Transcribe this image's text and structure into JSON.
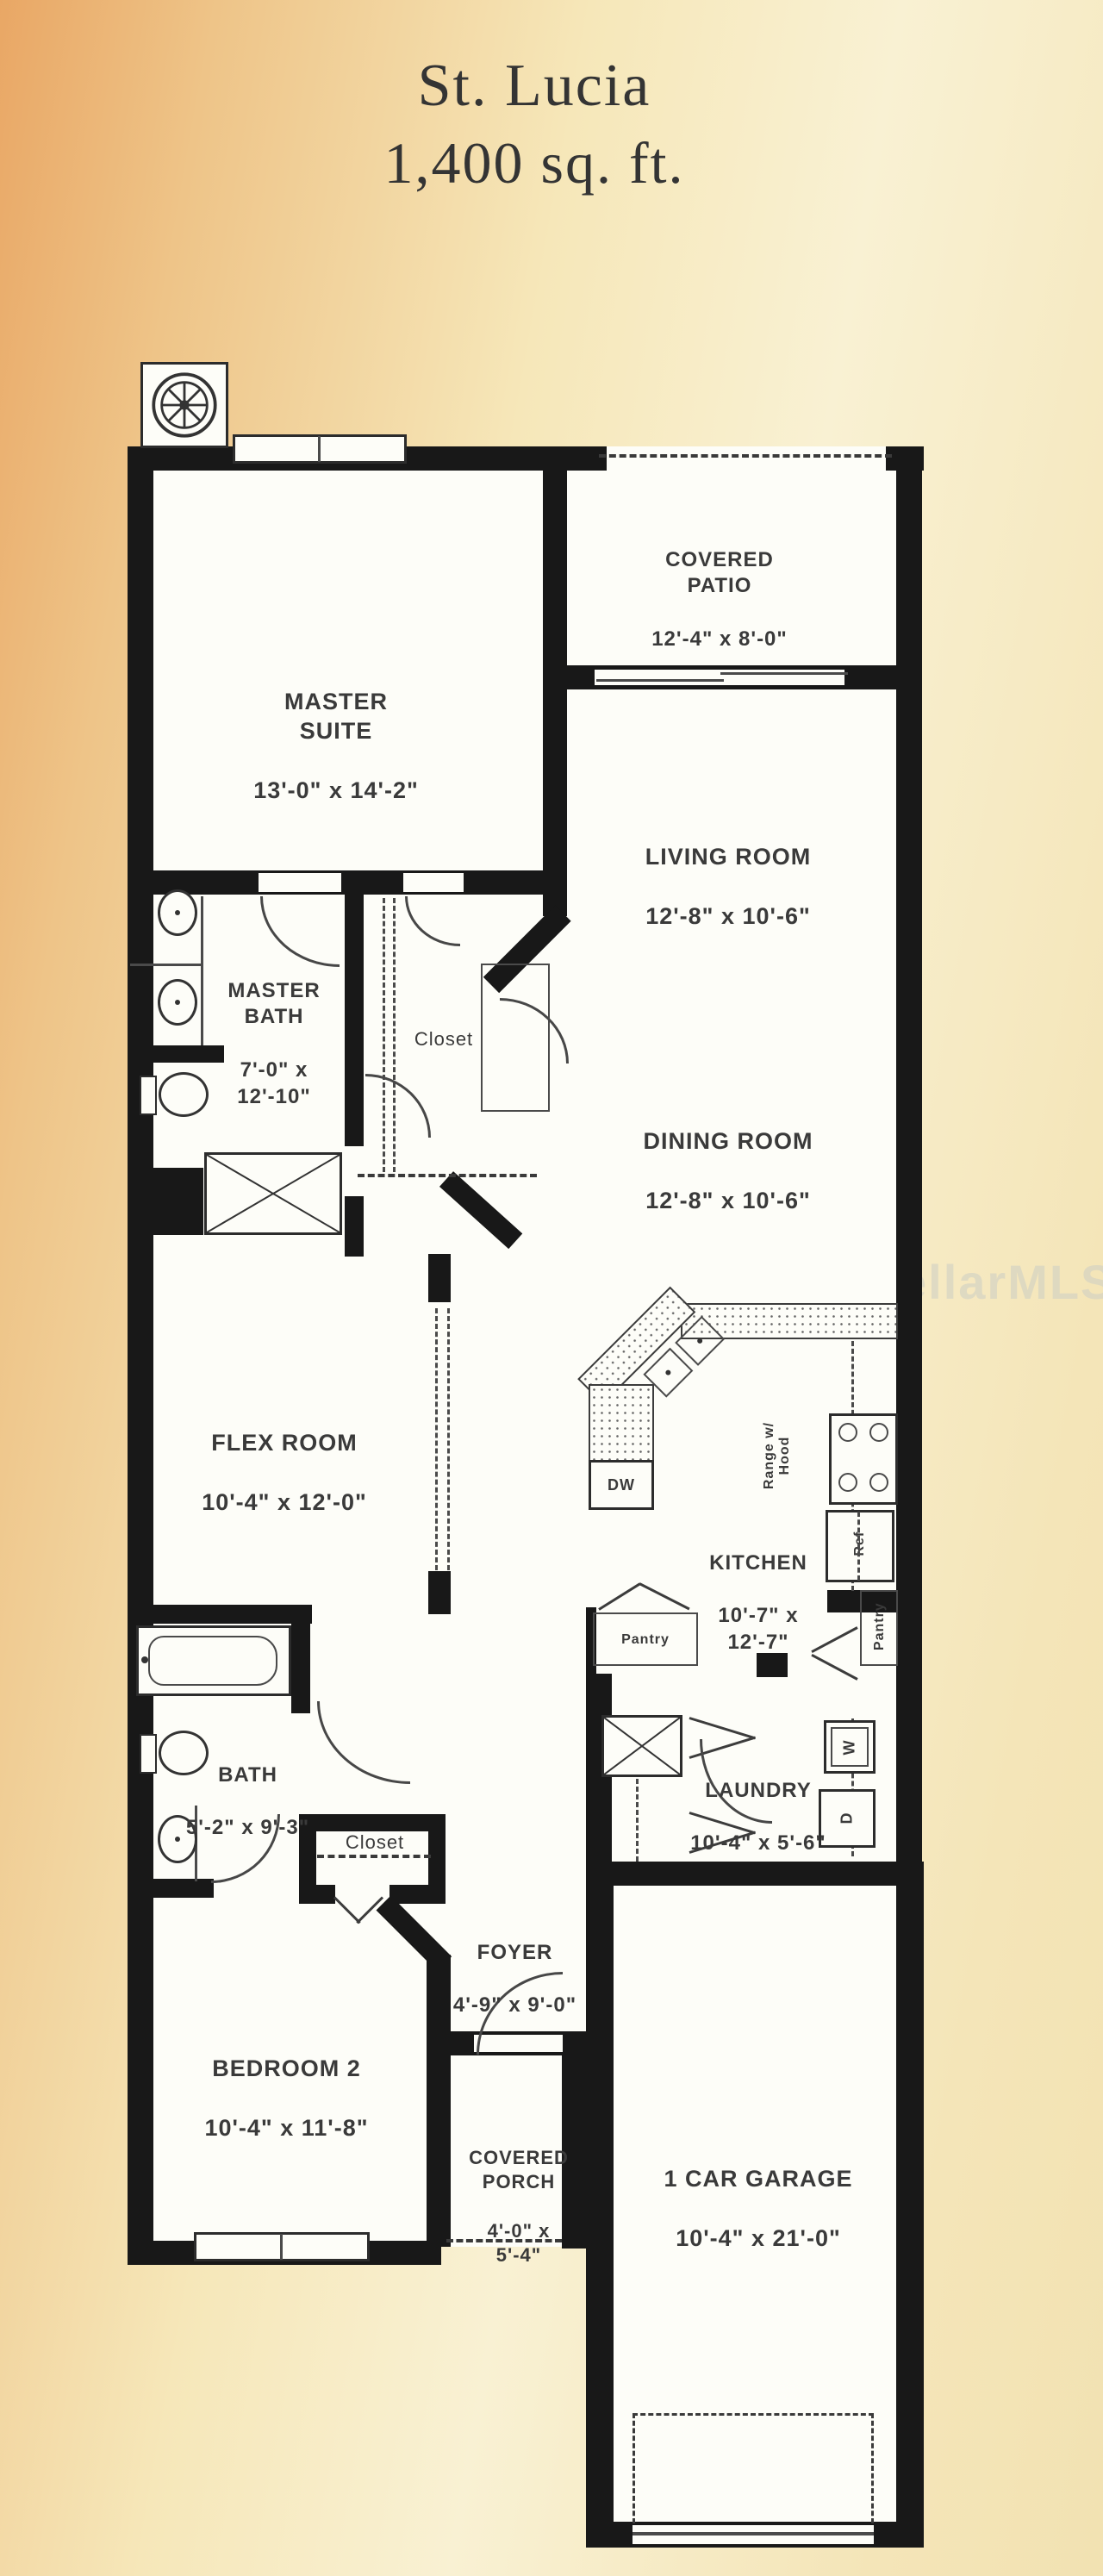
{
  "title": {
    "name": "St. Lucia",
    "area": "1,400 sq. ft."
  },
  "watermark": "StellarMLS",
  "rooms": {
    "master_suite": {
      "label": "MASTER\nSUITE",
      "dims": "13'-0\" x 14'-2\""
    },
    "covered_patio": {
      "label": "COVERED\nPATIO",
      "dims": "12'-4\" x 8'-0\""
    },
    "living_room": {
      "label": "LIVING ROOM",
      "dims": "12'-8\" x 10'-6\""
    },
    "dining_room": {
      "label": "DINING ROOM",
      "dims": "12'-8\" x 10'-6\""
    },
    "master_bath": {
      "label": "MASTER\nBATH",
      "dims": "7'-0\" x\n12'-10\""
    },
    "master_closet": {
      "label": "Closet"
    },
    "flex_room": {
      "label": "FLEX ROOM",
      "dims": "10'-4\" x 12'-0\""
    },
    "kitchen": {
      "label": "KITCHEN",
      "dims": "10'-7\" x\n12'-7\""
    },
    "bath2": {
      "label": "BATH",
      "dims": "5'-2\" x 9'-3\""
    },
    "laundry": {
      "label": "LAUNDRY",
      "dims": "10'-4\" x 5'-6\""
    },
    "closet2": {
      "label": "Closet"
    },
    "foyer": {
      "label": "FOYER",
      "dims": "4'-9\" x 9'-0\""
    },
    "bedroom2": {
      "label": "BEDROOM 2",
      "dims": "10'-4\" x 11'-8\""
    },
    "covered_porch": {
      "label": "COVERED\nPORCH",
      "dims": "4'-0\" x\n5'-4\""
    },
    "garage": {
      "label": "1 CAR GARAGE",
      "dims": "10'-4\" x 21'-0\""
    }
  },
  "fixtures": {
    "dishwasher": "DW",
    "range": "Range w/\nHood",
    "refrigerator": "Ref",
    "pantry_left": "Pantry",
    "pantry_right": "Pantry",
    "washer": "W",
    "dryer": "D"
  },
  "colors": {
    "wall": "#181818",
    "text": "#3a3a3a",
    "bg_left": "#e9a765",
    "bg_right": "#f2e2b2",
    "paper": "#fdfdf8"
  }
}
